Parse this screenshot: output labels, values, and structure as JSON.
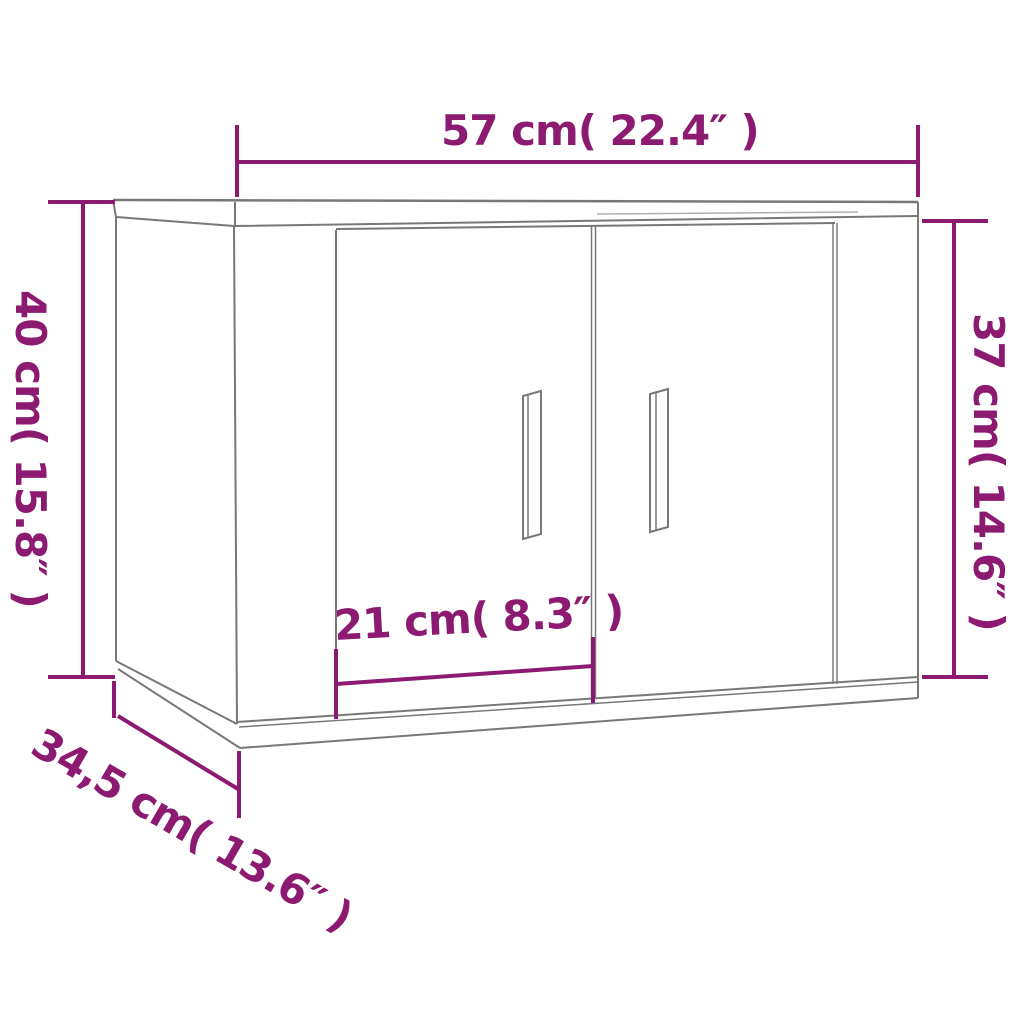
{
  "title": "Wall-mounted cabinet dimension diagram",
  "colors": {
    "accent": "#8C1A70",
    "line": "#787878",
    "background": "#FFFFFF"
  },
  "dimensions": {
    "width": {
      "label": "57 cm( 22.4″ )"
    },
    "height_left": {
      "label": "40 cm( 15.8″ )"
    },
    "height_right": {
      "label": "37 cm( 14.6″ )"
    },
    "door_width": {
      "label": "21 cm( 8.3″ )"
    },
    "depth": {
      "label": "34,5 cm( 13.6″ )"
    }
  }
}
